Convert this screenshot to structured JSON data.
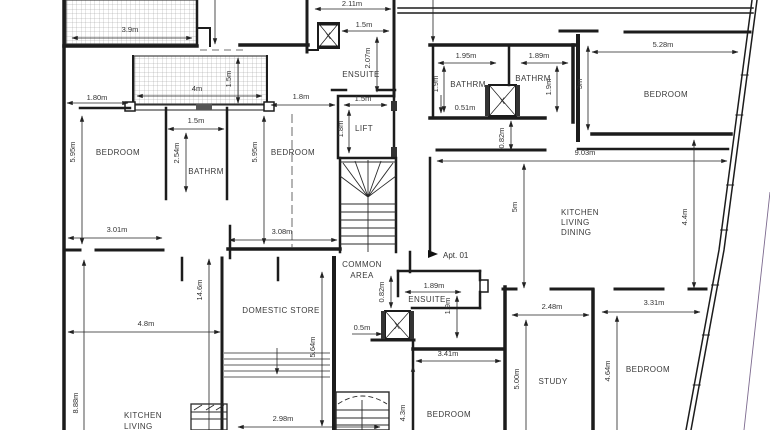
{
  "drawing": {
    "type": "architectural-floor-plan",
    "apartment_marker": "Apt. 01",
    "shaft_label": "X",
    "rooms": {
      "bedroom_top_left": "BEDROOM",
      "bathroom_left": "BATHRM",
      "bedroom_center": "BEDROOM",
      "ensuite_top": "ENSUITE",
      "lift": "LIFT",
      "bathroom_mid_left": "BATHRM",
      "bathroom_mid_right": "BATHRM",
      "bedroom_top_right": "BEDROOM",
      "kitchen_line1": "KITCHEN",
      "kitchen_line2": "LIVING",
      "kitchen_line3": "DINING",
      "common_line1": "COMMON",
      "common_line2": "AREA",
      "domestic_store": "DOMESTIC STORE",
      "ensuite_bottom": "ENSUITE",
      "bedroom_bottom_center": "BEDROOM",
      "study": "STUDY",
      "bedroom_bottom_right": "BEDROOM",
      "kitchen_living_line1": "KITCHEN",
      "kitchen_living_line2": "LIVING"
    },
    "dimensions": {
      "terrace_width": "3.9m",
      "opening_left": "1.80m",
      "balcony_width": "4m",
      "balcony_depth": "1.5m",
      "bedroom_tl_height": "5.95m",
      "bathrm_left_width": "1.5m",
      "bathrm_left_height": "2.54m",
      "bedroom_tl_width": "3.01m",
      "bedroom_c_height": "5.95m",
      "corridor_top": "1.8m",
      "bedroom_c_width": "3.08m",
      "ensuite_top_width": "2.11m",
      "ensuite_top_inner": "1.5m",
      "ensuite_top_depth": "2.07m",
      "lift_width": "1.5m",
      "lift_depth": "1.8m",
      "bathrm_m1_width": "1.95m",
      "bathrm_m1_depth": "1.9m",
      "bathrm_m1_offset": "0.51m",
      "bathrm_m2_width": "1.89m",
      "bathrm_m2_depth": "1.9m",
      "bedroom_tr_depth": "3m",
      "bedroom_tr_width": "5.28m",
      "shaft_offset_top": "0.82m",
      "kitchen_width": "9.03m",
      "kitchen_depth": "5m",
      "kitchen_right_depth": "4.4m",
      "plan_height_left": "14.6m",
      "kitchen_bl_width": "4.8m",
      "kitchen_bl_height": "8.88m",
      "store_height": "5.64m",
      "store_width": "2.98m",
      "shaft_offset_bottom": "0.82m",
      "ensuite_b_width": "1.89m",
      "ensuite_b_depth": "1.9m",
      "shaft_b_width": "0.5m",
      "bedroom_bc_width": "3.41m",
      "bedroom_bc_height": "4.3m",
      "study_width": "2.48m",
      "study_height": "5.00m",
      "bedroom_br_width": "3.31m",
      "bedroom_br_height": "4.64m"
    }
  }
}
